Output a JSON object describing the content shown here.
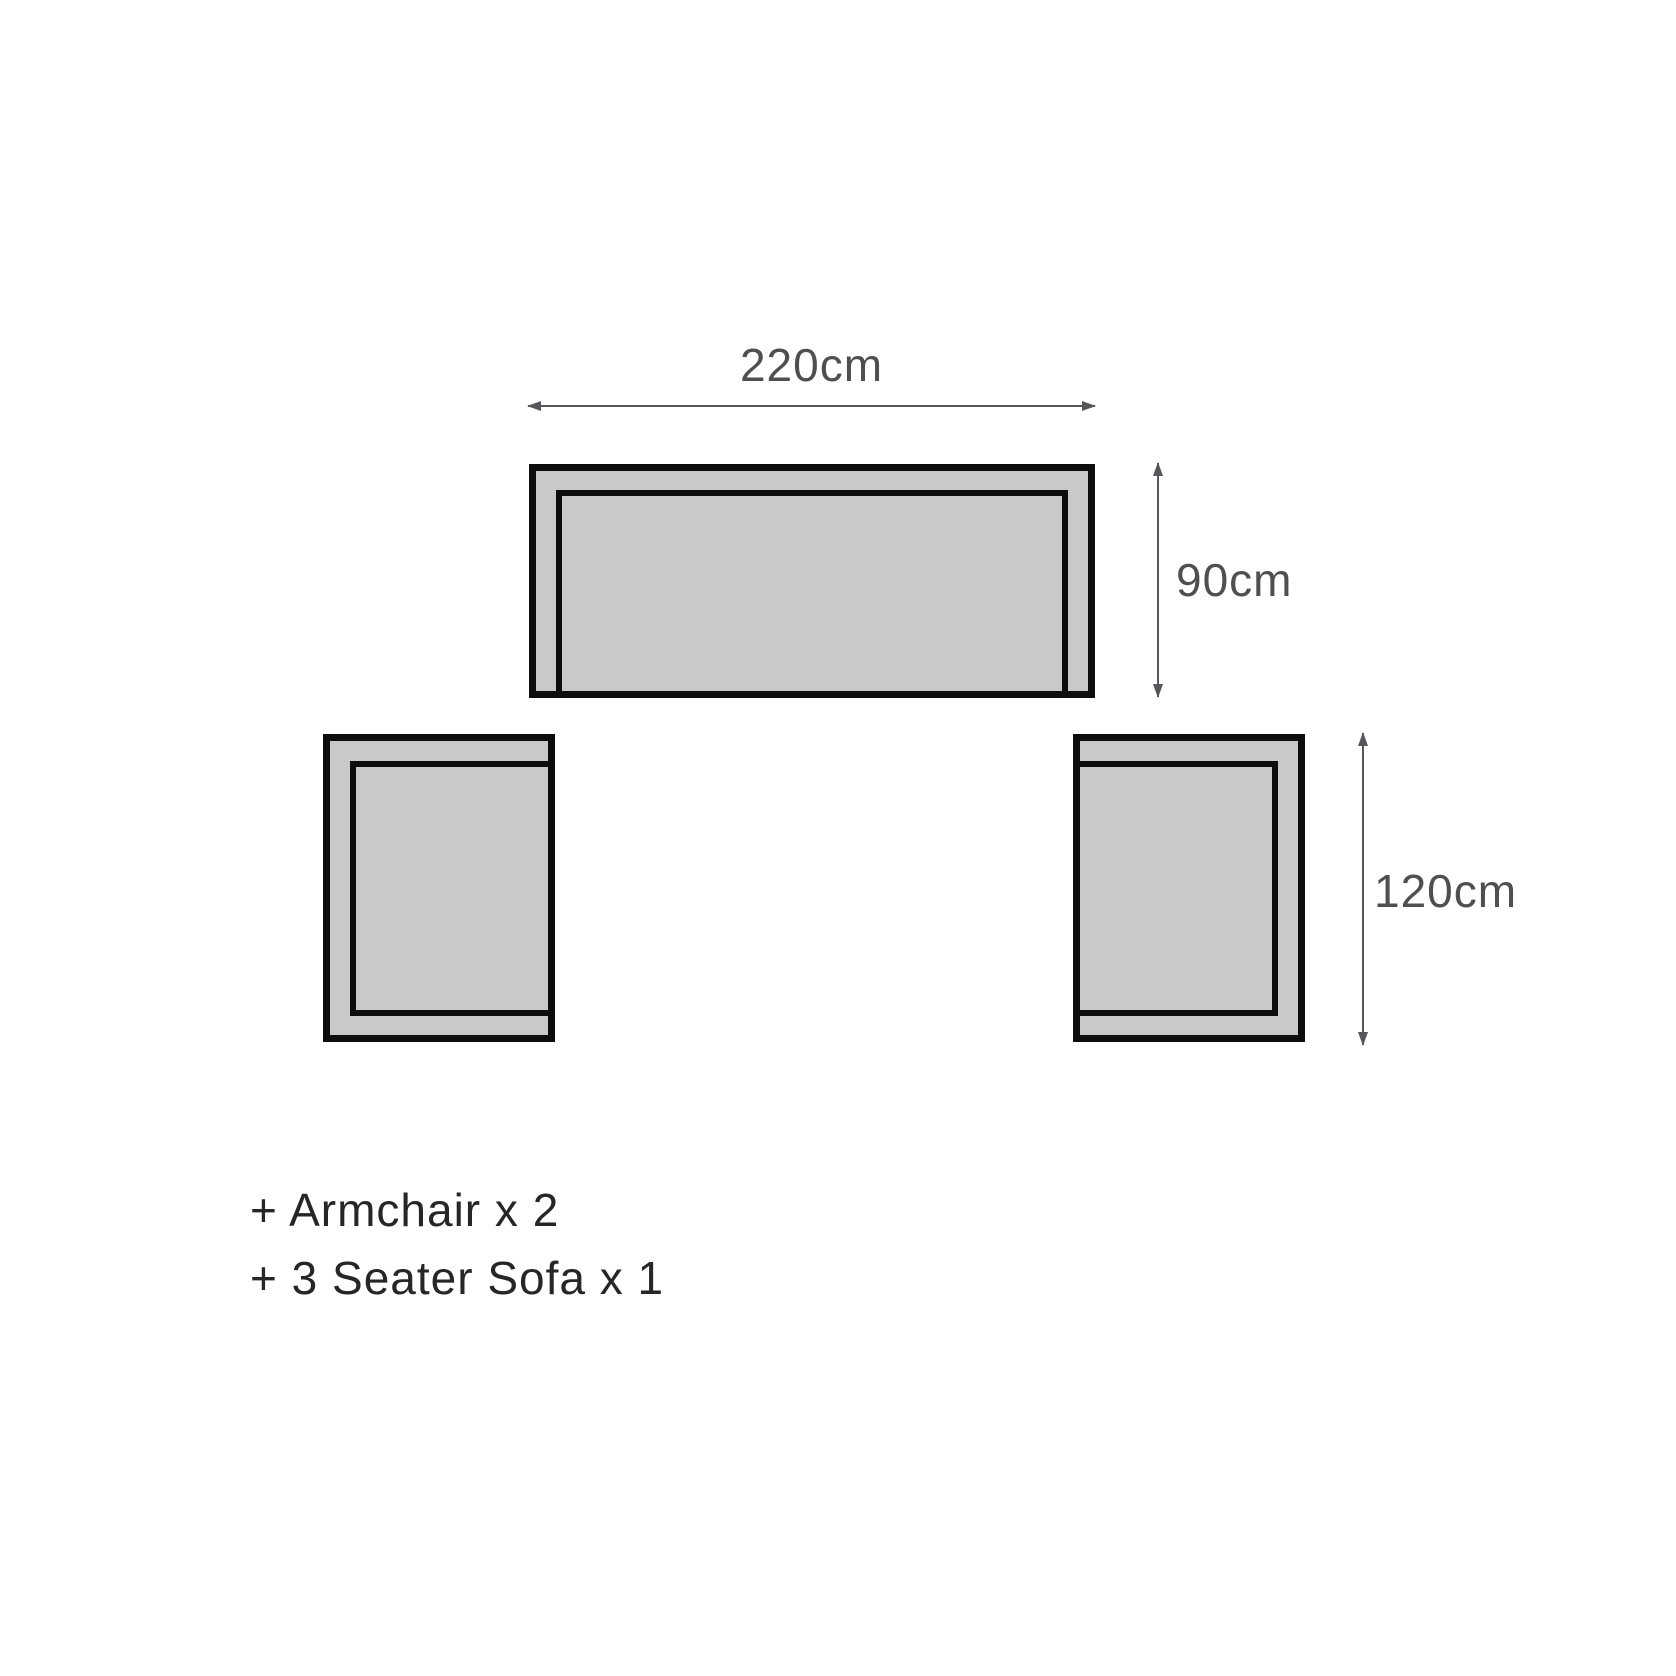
{
  "diagram": {
    "sofa": {
      "width_label": "220cm",
      "depth_label": "90cm"
    },
    "armchairs": {
      "depth_label": "120cm"
    },
    "legend": {
      "line1": "+ Armchair x 2",
      "line2": "+ 3 Seater Sofa x 1"
    },
    "colors": {
      "furniture_fill": "#c9c9c9",
      "furniture_outline": "#0d0d0d",
      "dimension_line": "#56575b",
      "dimension_text": "#4f4f4f",
      "legend_text": "#262626",
      "background": "#ffffff"
    }
  }
}
